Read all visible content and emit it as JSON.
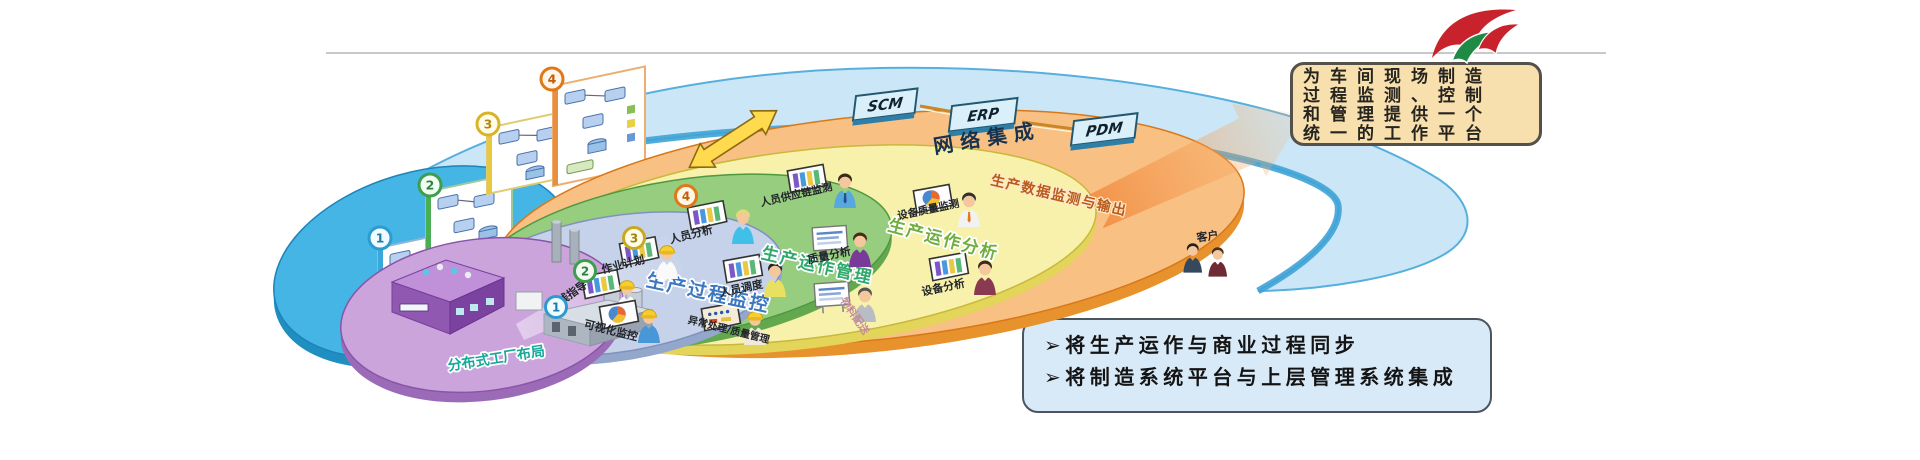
{
  "top_note": {
    "line1": "为车间现场制造",
    "line2": "过程监测、控制",
    "line3": "和管理提供一个",
    "line4": "统一的工作平台"
  },
  "callout": {
    "bullet": "➢",
    "item1": "将生产运作与商业过程同步",
    "item2": "将制造系统平台与上层管理系统集成"
  },
  "band": {
    "label": "网络集成",
    "systems": [
      "SCM",
      "ERP",
      "PDM"
    ]
  },
  "model": {
    "line1": "制造过程扩展",
    "line2": "模型",
    "panels": [
      "1",
      "2",
      "3",
      "4"
    ]
  },
  "layers": {
    "l4": {
      "num": "4",
      "title": "生产数据监测与输出",
      "item1": "人员供应链监测",
      "item2": "设备质量监测",
      "item3": "客户"
    },
    "l3": {
      "num": "3",
      "title": "生产运作分析",
      "item1": "人员分析",
      "item2": "质量分析",
      "item3": "设备分析"
    },
    "l2": {
      "num": "2",
      "title": "生产运作管理",
      "item1": "作业计划",
      "item2": "人员调度",
      "item3": "物料配送"
    },
    "l1": {
      "num": "1",
      "title": "生产过程监控",
      "item1": "在线指导",
      "item2": "可视化监控",
      "item3": "异常处理/质量管理"
    },
    "l0": {
      "title": "分布式工厂布局"
    }
  },
  "colors": {
    "band_fill": "#CBE7F7",
    "band_edge": "#57AFDD",
    "ring4": "#F9C083",
    "ring3": "#F7F1AB",
    "ring2": "#97CD7F",
    "ring1": "#C6D2E9",
    "ring0": "#CBA4DC",
    "model_ellipse": "#45B5E5",
    "note_bg": "#F7DFAE",
    "callout_bg": "#D8E9F8",
    "logo_red": "#C8232C",
    "logo_green": "#1F8A44"
  }
}
